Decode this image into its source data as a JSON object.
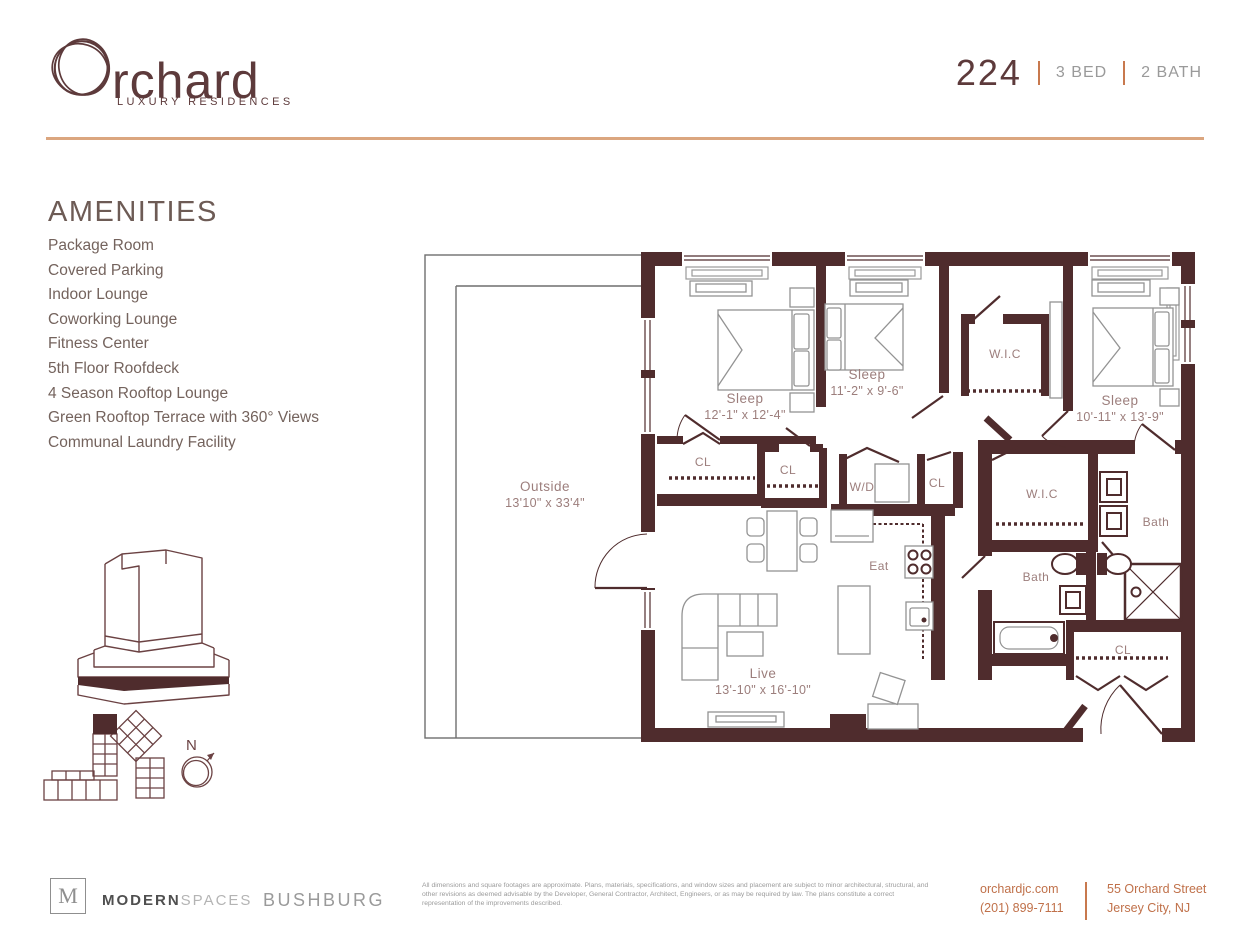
{
  "brand": {
    "name": "Orchard",
    "wordmark_rest": "rchard",
    "tagline": "LUXURY RESIDENCES"
  },
  "unit": {
    "number": "224",
    "specs": [
      "3 BED",
      "2 BATH"
    ]
  },
  "amenities": {
    "heading": "AMENITIES",
    "items": [
      "Package Room",
      "Covered Parking",
      "Indoor Lounge",
      "Coworking Lounge",
      "Fitness Center",
      "5th Floor Roofdeck",
      "4 Season Rooftop Lounge",
      "Green Rooftop Terrace with 360° Views",
      "Communal Laundry Facility"
    ]
  },
  "floorplan": {
    "compass": "N",
    "rooms": [
      {
        "name": "Sleep",
        "dims": "12'-1\" x 12'-4\"",
        "x": 325,
        "y": 155
      },
      {
        "name": "Sleep",
        "dims": "11'-2\" x 9'-6\"",
        "x": 447,
        "y": 131
      },
      {
        "name": "W.I.C",
        "dims": "",
        "x": 585,
        "y": 110
      },
      {
        "name": "Sleep",
        "dims": "10'-11\" x 13'-9\"",
        "x": 700,
        "y": 157
      },
      {
        "name": "CL",
        "dims": "",
        "x": 283,
        "y": 218
      },
      {
        "name": "CL",
        "dims": "",
        "x": 368,
        "y": 226
      },
      {
        "name": "W/D",
        "dims": "",
        "x": 442,
        "y": 243
      },
      {
        "name": "CL",
        "dims": "",
        "x": 517,
        "y": 239
      },
      {
        "name": "W.I.C",
        "dims": "",
        "x": 622,
        "y": 250
      },
      {
        "name": "Bath",
        "dims": "",
        "x": 736,
        "y": 278
      },
      {
        "name": "Eat",
        "dims": "",
        "x": 459,
        "y": 322
      },
      {
        "name": "Bath",
        "dims": "",
        "x": 616,
        "y": 333
      },
      {
        "name": "Outside",
        "dims": "13'10\" x 33'4\"",
        "x": 125,
        "y": 243
      },
      {
        "name": "Live",
        "dims": "13'-10\" x 16'-10\"",
        "x": 343,
        "y": 430
      },
      {
        "name": "CL",
        "dims": "",
        "x": 703,
        "y": 406
      }
    ]
  },
  "footer": {
    "broker_logo_letter": "M",
    "broker_bold": "MODERN",
    "broker_light": "SPACES",
    "developer": "BUSHBURG",
    "disclaimer": "All dimensions and square footages are approximate. Plans, materials, specifications, and window sizes and placement are subject to minor architectural, structural, and other revisions as deemed advisable by the Developer, General Contractor, Architect, Engineers, or as may be required by law. The plans constitute a correct representation of the improvements described.",
    "website": "orchardjc.com",
    "phone": "(201) 899-7111",
    "address_line1": "55 Orchard Street",
    "address_line2": "Jersey City, NJ"
  },
  "colors": {
    "wall": "#4f2c2d",
    "brand_maroon": "#5d3a3b",
    "accent_orange": "#c8794e",
    "divider_tan": "#dba67f",
    "room_label": "#9c7e7c"
  }
}
